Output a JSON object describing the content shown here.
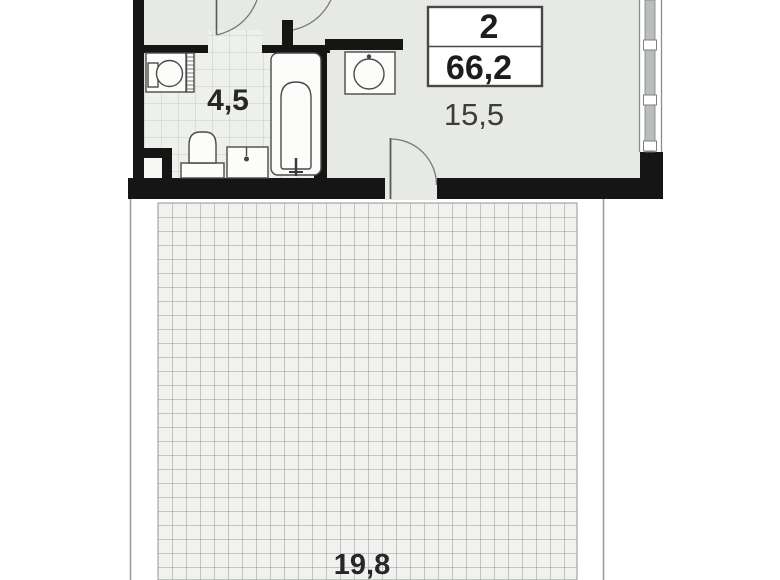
{
  "unit_badge": {
    "rooms_count": "2",
    "total_area": "66,2"
  },
  "room_labels": {
    "bathroom": "4,5",
    "living": "15,5",
    "terrace": "19,8"
  },
  "colors": {
    "wall": "#151515",
    "floor": "#e7e9e5",
    "bath_tile_bg": "#eef0ec",
    "bath_tile_line": "#c6cac5",
    "terrace_grid_bg": "#f1f2ef",
    "terrace_grid_line": "#8f9896",
    "window_glass": "#b9beba",
    "fixture_fill": "#fcfdfb",
    "fixture_stroke": "#4a4a4a",
    "door_arc": "#787878",
    "label_text": "#272727",
    "label_text_light": "#3d3d3d"
  }
}
